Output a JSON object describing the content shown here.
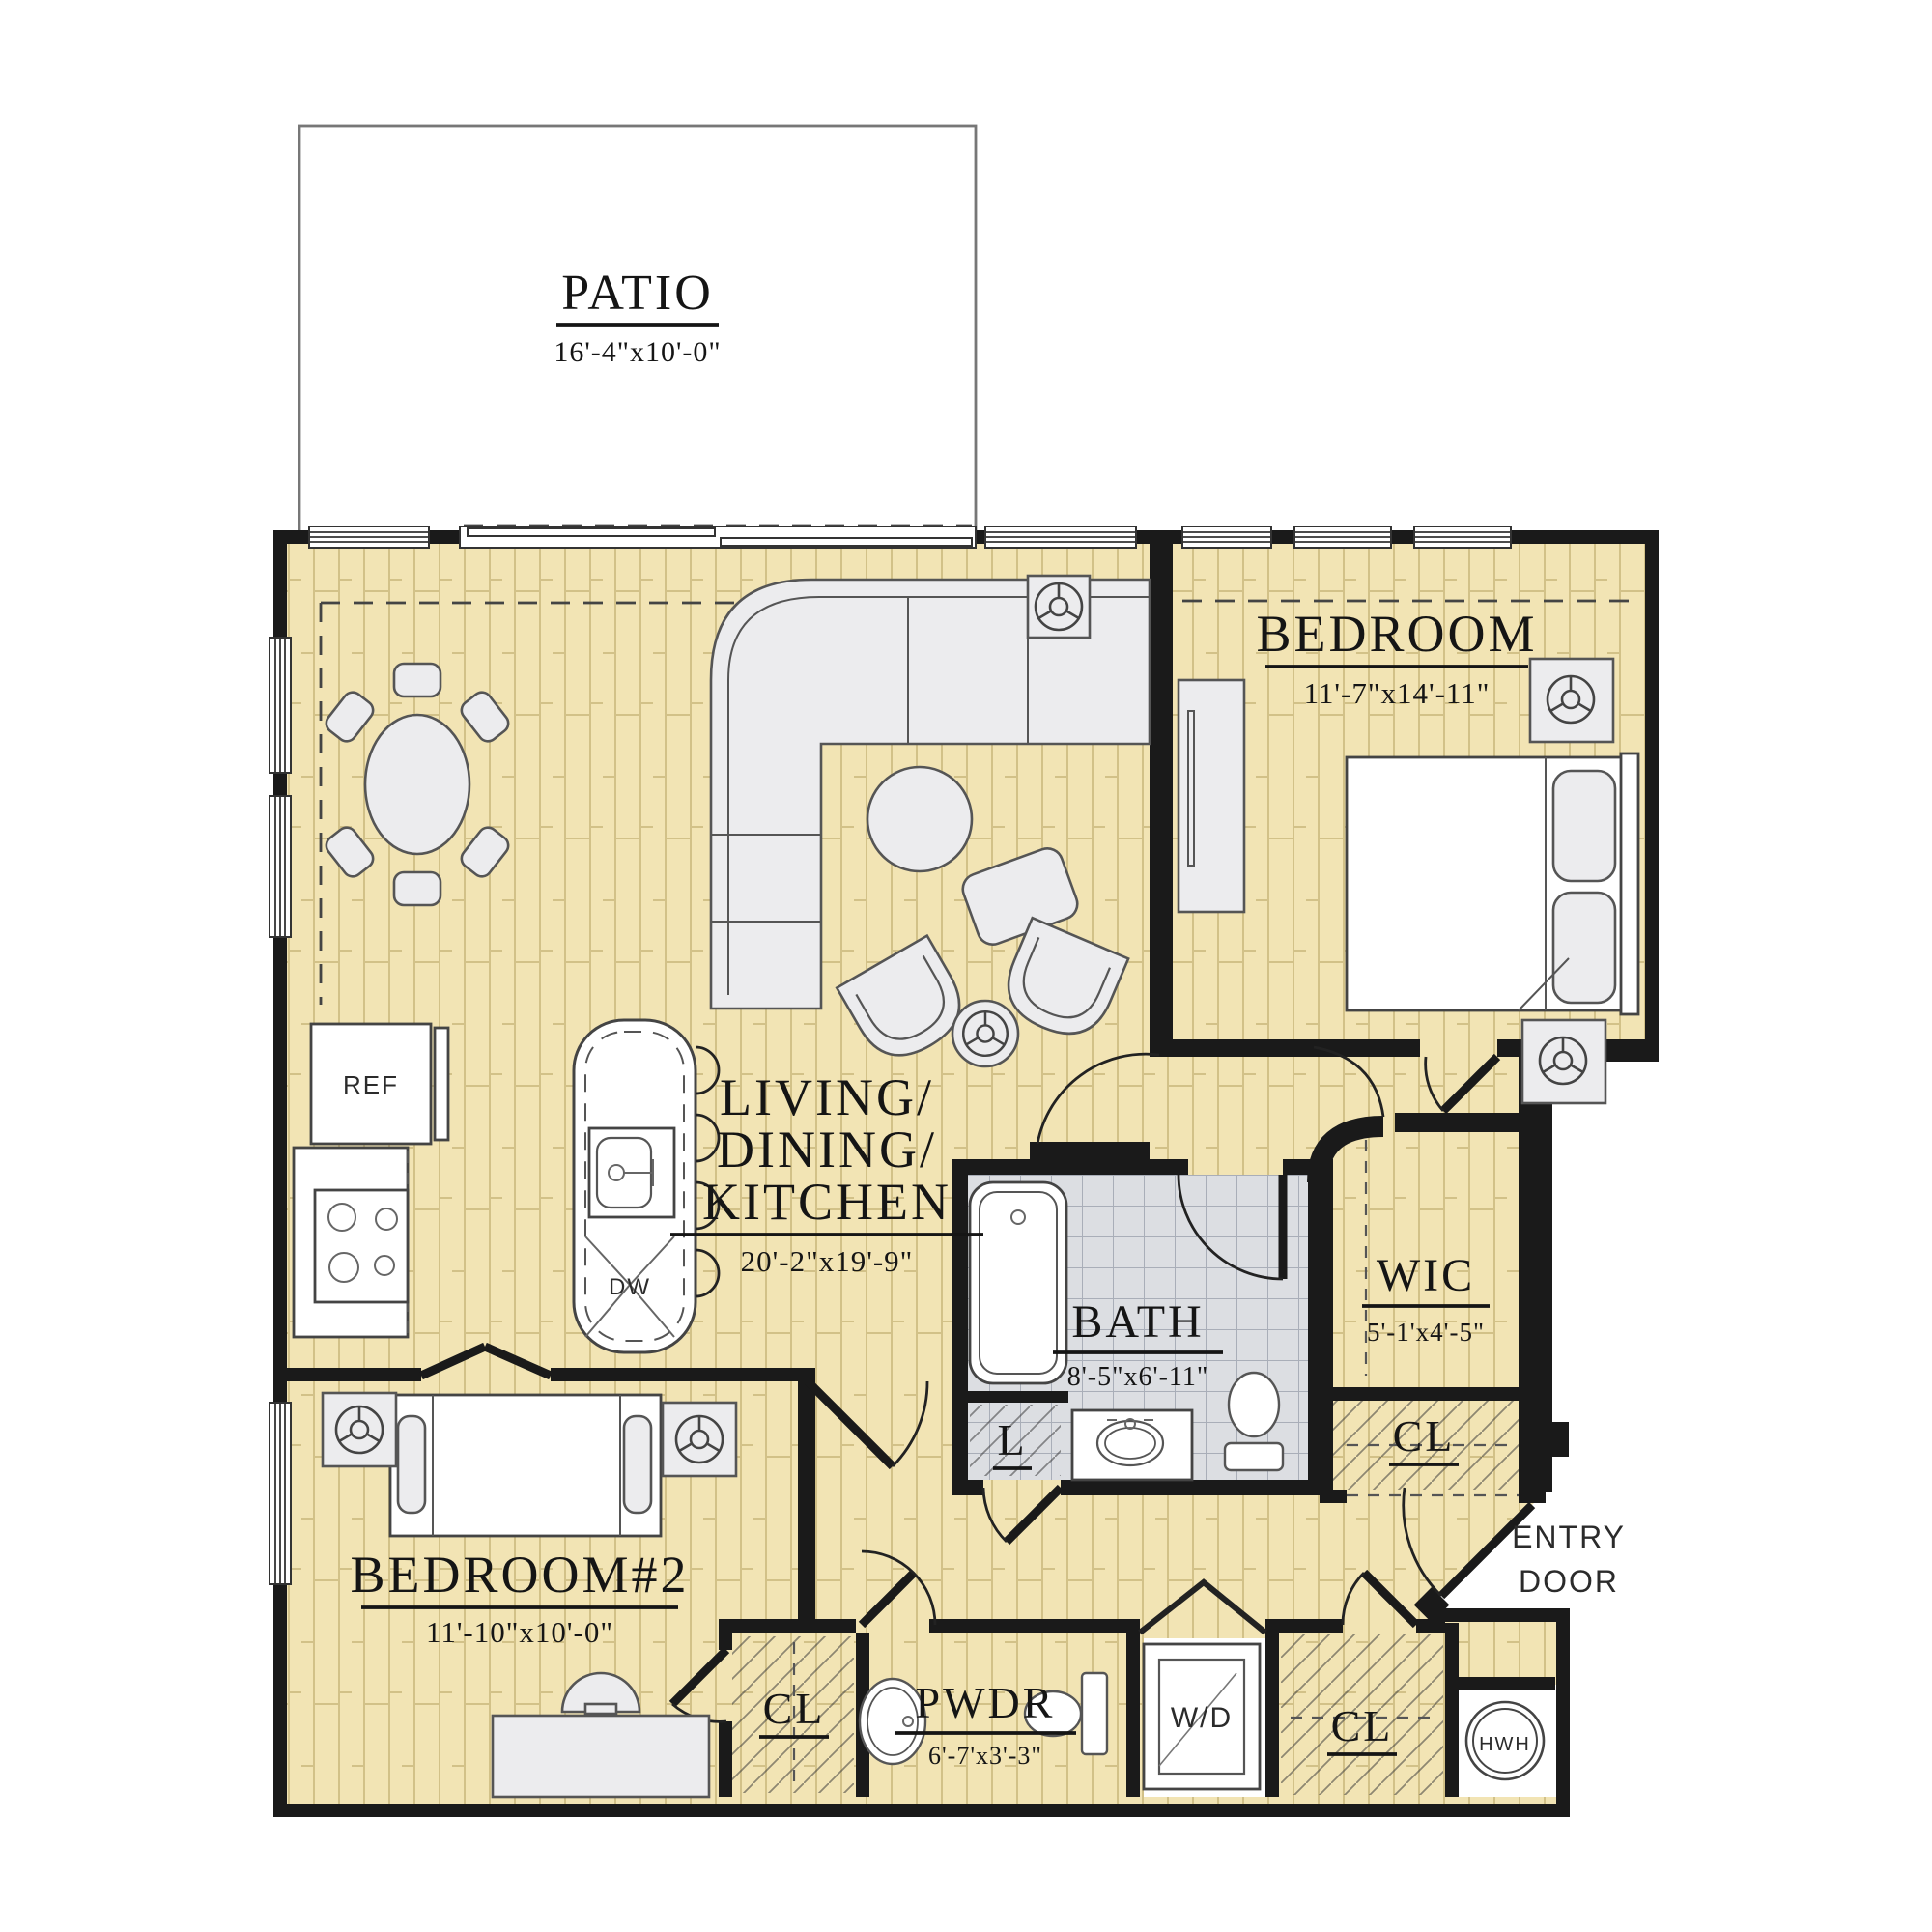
{
  "plan": {
    "title": "apartment-floor-plan",
    "rooms": {
      "patio": {
        "name": "PATIO",
        "dim": "16'-4\"x10'-0\""
      },
      "bedroom": {
        "name": "BEDROOM",
        "dim": "11'-7\"x14'-11\""
      },
      "living": {
        "name_line1": "LIVING/",
        "name_line2": "DINING/",
        "name_line3": "KITCHEN",
        "dim": "20'-2\"x19'-9\""
      },
      "bath": {
        "name": "BATH",
        "dim": "8'-5\"x6'-11\""
      },
      "wic": {
        "name": "WIC",
        "dim": "5'-1'x4'-5\""
      },
      "bedroom2": {
        "name": "BEDROOM#2",
        "dim": "11'-10\"x10'-0\""
      },
      "pwdr": {
        "name": "PWDR",
        "dim": "6'-7'x3'-3\""
      }
    },
    "closets": {
      "hall": {
        "label": "CL"
      },
      "bedroom2": {
        "label": "CL"
      },
      "entry": {
        "label": "CL"
      },
      "linen": {
        "label": "L"
      }
    },
    "fixtures": {
      "refrigerator": "REF",
      "dishwasher": "DW",
      "washer_dryer": "W/D",
      "water_heater": "HWH"
    },
    "entry": {
      "line1": "ENTRY",
      "line2": "DOOR"
    },
    "colors": {
      "floor": "#f2e4b4",
      "plank_line": "#d2c188",
      "wall": "#1a1a1a",
      "bath_tile": "#dcdee2",
      "furniture": "#ececee",
      "background": "#ffffff"
    }
  }
}
